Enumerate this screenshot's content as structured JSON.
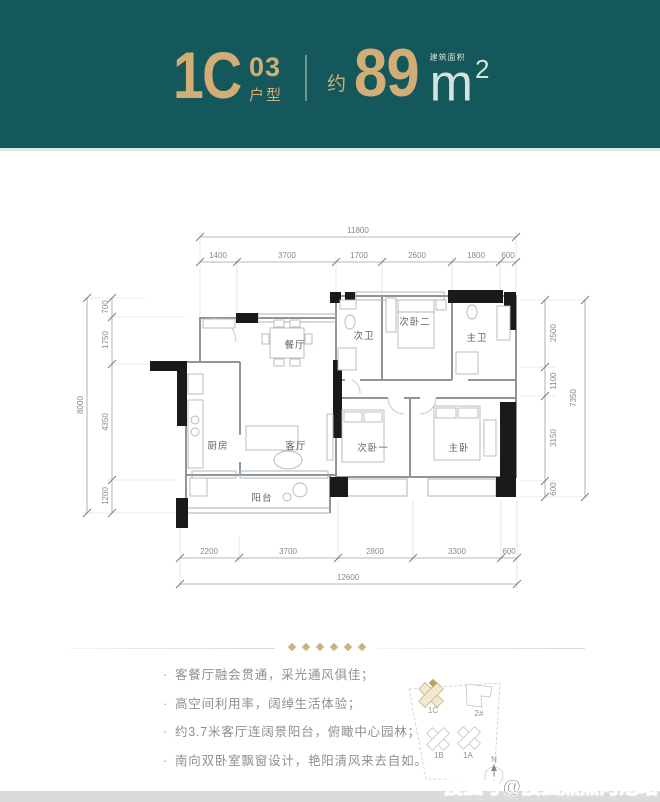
{
  "header": {
    "code": "1C",
    "code_sup": "03",
    "code_sub": "户型",
    "approx": "约",
    "area": "89",
    "area_label": "建筑面积",
    "unit": "m",
    "unit_sup": "2",
    "teal_color": "#15585c",
    "gold_color": "#d3ad76"
  },
  "plan": {
    "rooms": {
      "dining": "餐厅",
      "kitchen": "厨房",
      "living": "客厅",
      "balcony": "阳台",
      "bath2": "次卫",
      "bed2": "次卧二",
      "master_bath": "主卫",
      "bed1": "次卧一",
      "master_bed": "主卧"
    },
    "dims": {
      "top_total": "11800",
      "top_segments": [
        "1400",
        "3700",
        "1700",
        "2600",
        "1800",
        "600"
      ],
      "bottom_segments": [
        "2200",
        "3700",
        "2800",
        "3300",
        "600"
      ],
      "bottom_total": "12600",
      "left_total": "8000",
      "left_segments": [
        "700",
        "1750",
        "4350",
        "1200"
      ],
      "right_segments": [
        "2500",
        "1100",
        "3150",
        "600"
      ],
      "right_total": "7350"
    }
  },
  "features": {
    "bullet": "·",
    "items": [
      "客餐厅融会贯通，采光通风俱佳；",
      "高空间利用率，阔绰生活体验；",
      "约3.7米客厅连阔景阳台，俯瞰中心园林；",
      "南向双卧室飘窗设计，艳阳清风来去自如。"
    ]
  },
  "siteplan": {
    "labels": {
      "b1c": "1C",
      "b2": "2#",
      "b1b": "1B",
      "b1a": "1A",
      "north": "N"
    }
  },
  "watermark": "搜狐号@搜狐焦点河池站"
}
